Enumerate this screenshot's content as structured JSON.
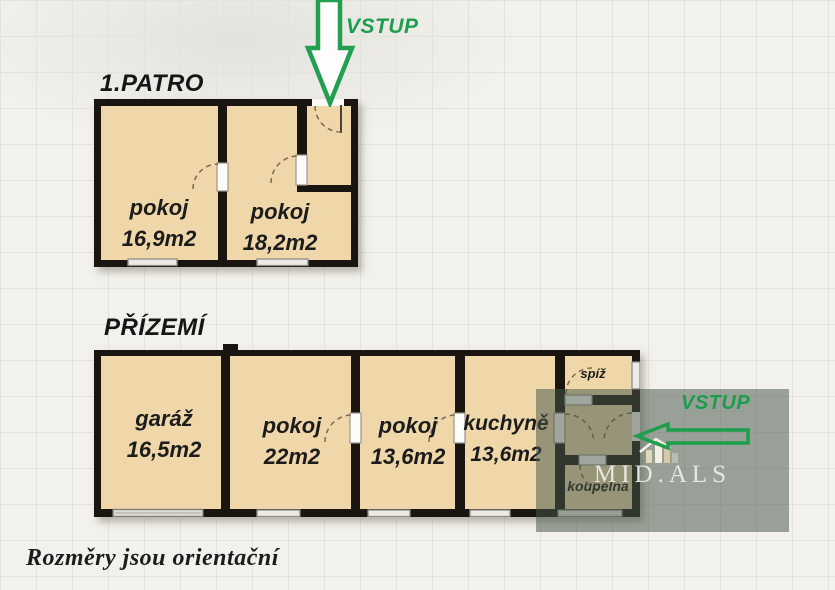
{
  "colors": {
    "accent_green": "#1d9e4d",
    "room_fill": "#f0d7a9",
    "wall": "#1a1510",
    "overlay": "rgba(70,86,72,0.52)"
  },
  "entrance_top": {
    "label": "VSTUP"
  },
  "entrance_right": {
    "label": "VSTUP"
  },
  "floors": [
    {
      "label": "1.PATRO",
      "rooms": [
        {
          "name": "pokoj",
          "area": "16,9m2"
        },
        {
          "name": "pokoj",
          "area": "18,2m2"
        }
      ]
    },
    {
      "label": "PŘÍZEMÍ",
      "rooms": [
        {
          "name": "garáž",
          "area": "16,5m2"
        },
        {
          "name": "pokoj",
          "area": "22m2"
        },
        {
          "name": "pokoj",
          "area": "13,6m2"
        },
        {
          "name": "kuchyně",
          "area": "13,6m2"
        },
        {
          "name": "spíž",
          "area": ""
        },
        {
          "name": "koupelna",
          "area": ""
        }
      ]
    }
  ],
  "watermark": {
    "brand": "MID.ALS"
  },
  "footnote": "Rozměry jsou orientační"
}
